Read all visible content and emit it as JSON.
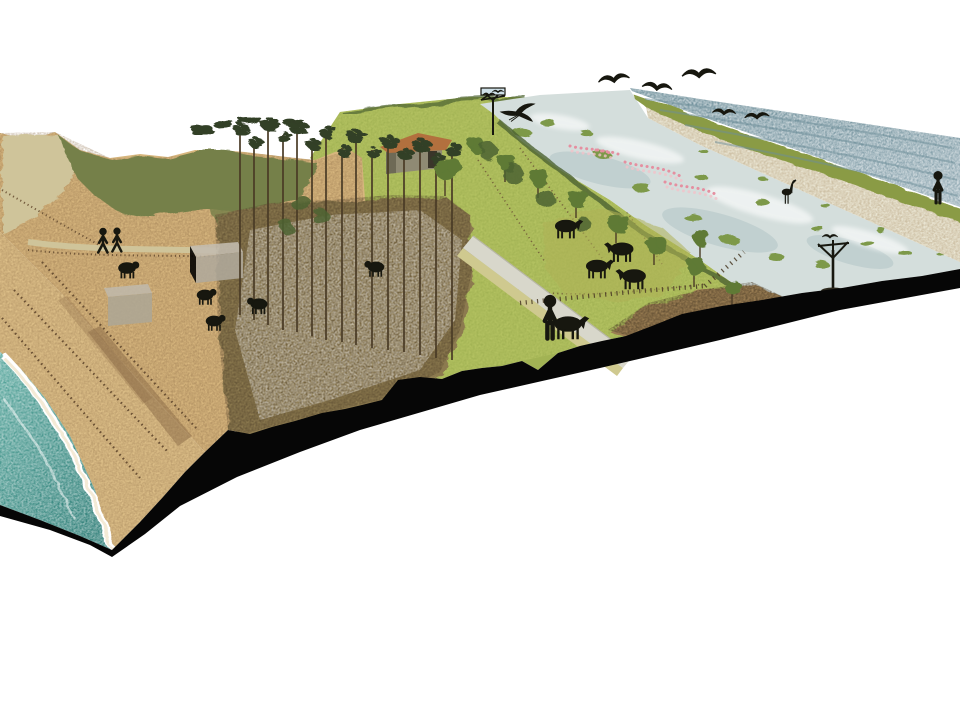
{
  "canvas": {
    "width": 960,
    "height": 720,
    "background": "#ffffff"
  },
  "colors": {
    "white": "#ffffff",
    "sea_teal_light": "#5ba99f",
    "sea_teal_dark": "#2e7e77",
    "foam": "#f4ead6",
    "beach": "#ddbf88",
    "beach_shade": "#8a6a45",
    "dune_sand": "#d7b67e",
    "dune_grass": "#74804a",
    "dry_grass": "#cfc49a",
    "scrub_floor": "#8c7a4f",
    "pine_canopy": "#333f28",
    "trunk_brown": "#4a3b26",
    "meadow": "#a2b354",
    "meadow_bright": "#c3cf6d",
    "tree_green": "#5e7a36",
    "bush_dark": "#4d6330",
    "hut_wall": "#8f8a74",
    "hut_roof": "#b2703e",
    "road_grey": "#d8d7cb",
    "verge": "#cfc98f",
    "pasture": "#afb257",
    "mudflat": "#9b7e52",
    "lagoon": "#d4dedc",
    "lagoon_shade": "#b8c9ca",
    "reed_green": "#7d9949",
    "flamingo_pink": "#e58fa0",
    "flamingo_pale": "#f2c3ca",
    "dike_grass": "#8a9b44",
    "dike_sand": "#ebe7d5",
    "sea_outer": "#92aab4",
    "sea_outer_dark": "#6d8e99",
    "cut_black": "#060606",
    "silhouette": "#17170f",
    "fence_brown": "#6b5134"
  },
  "scene": {
    "type": "coastal-dune-landscape-axonometric-section",
    "zones": [
      "breaking-sea",
      "sandy-beach",
      "foredune-with-sand-fences",
      "vegetated-dune",
      "pine-grove",
      "dune-meadow",
      "grazing-pasture",
      "access-road",
      "mudflat",
      "brackish-lagoon",
      "sea-dike",
      "outer-sea",
      "section-cut"
    ],
    "fauna": {
      "gulls_flying": 5,
      "heron_flying": 1,
      "heron_wading": 1,
      "flamingo_flocks": 3,
      "cattle": 4,
      "sheep_goats": 5,
      "perched_birds": 3,
      "pony_dog": 1
    },
    "people": {
      "beach_path_walkers": 2,
      "road_walker": 1,
      "dike_watcher": 1
    },
    "structures": {
      "stone_hut": 1,
      "concrete_bunkers": 2,
      "nesting_platform": 1,
      "nesting_tree": 1,
      "sand_fence_rows": 3,
      "pasture_fences": 3
    }
  }
}
